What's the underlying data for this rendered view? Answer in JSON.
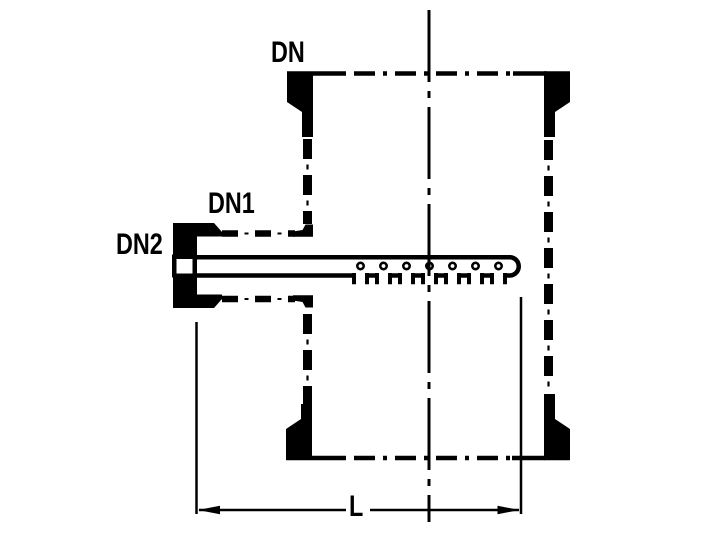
{
  "diagram": {
    "labels": {
      "dn": "DN",
      "dn1": "DN1",
      "dn2": "DN2",
      "length": "L"
    }
  },
  "colors": {
    "ink": "#000000",
    "background": "#ffffff"
  }
}
